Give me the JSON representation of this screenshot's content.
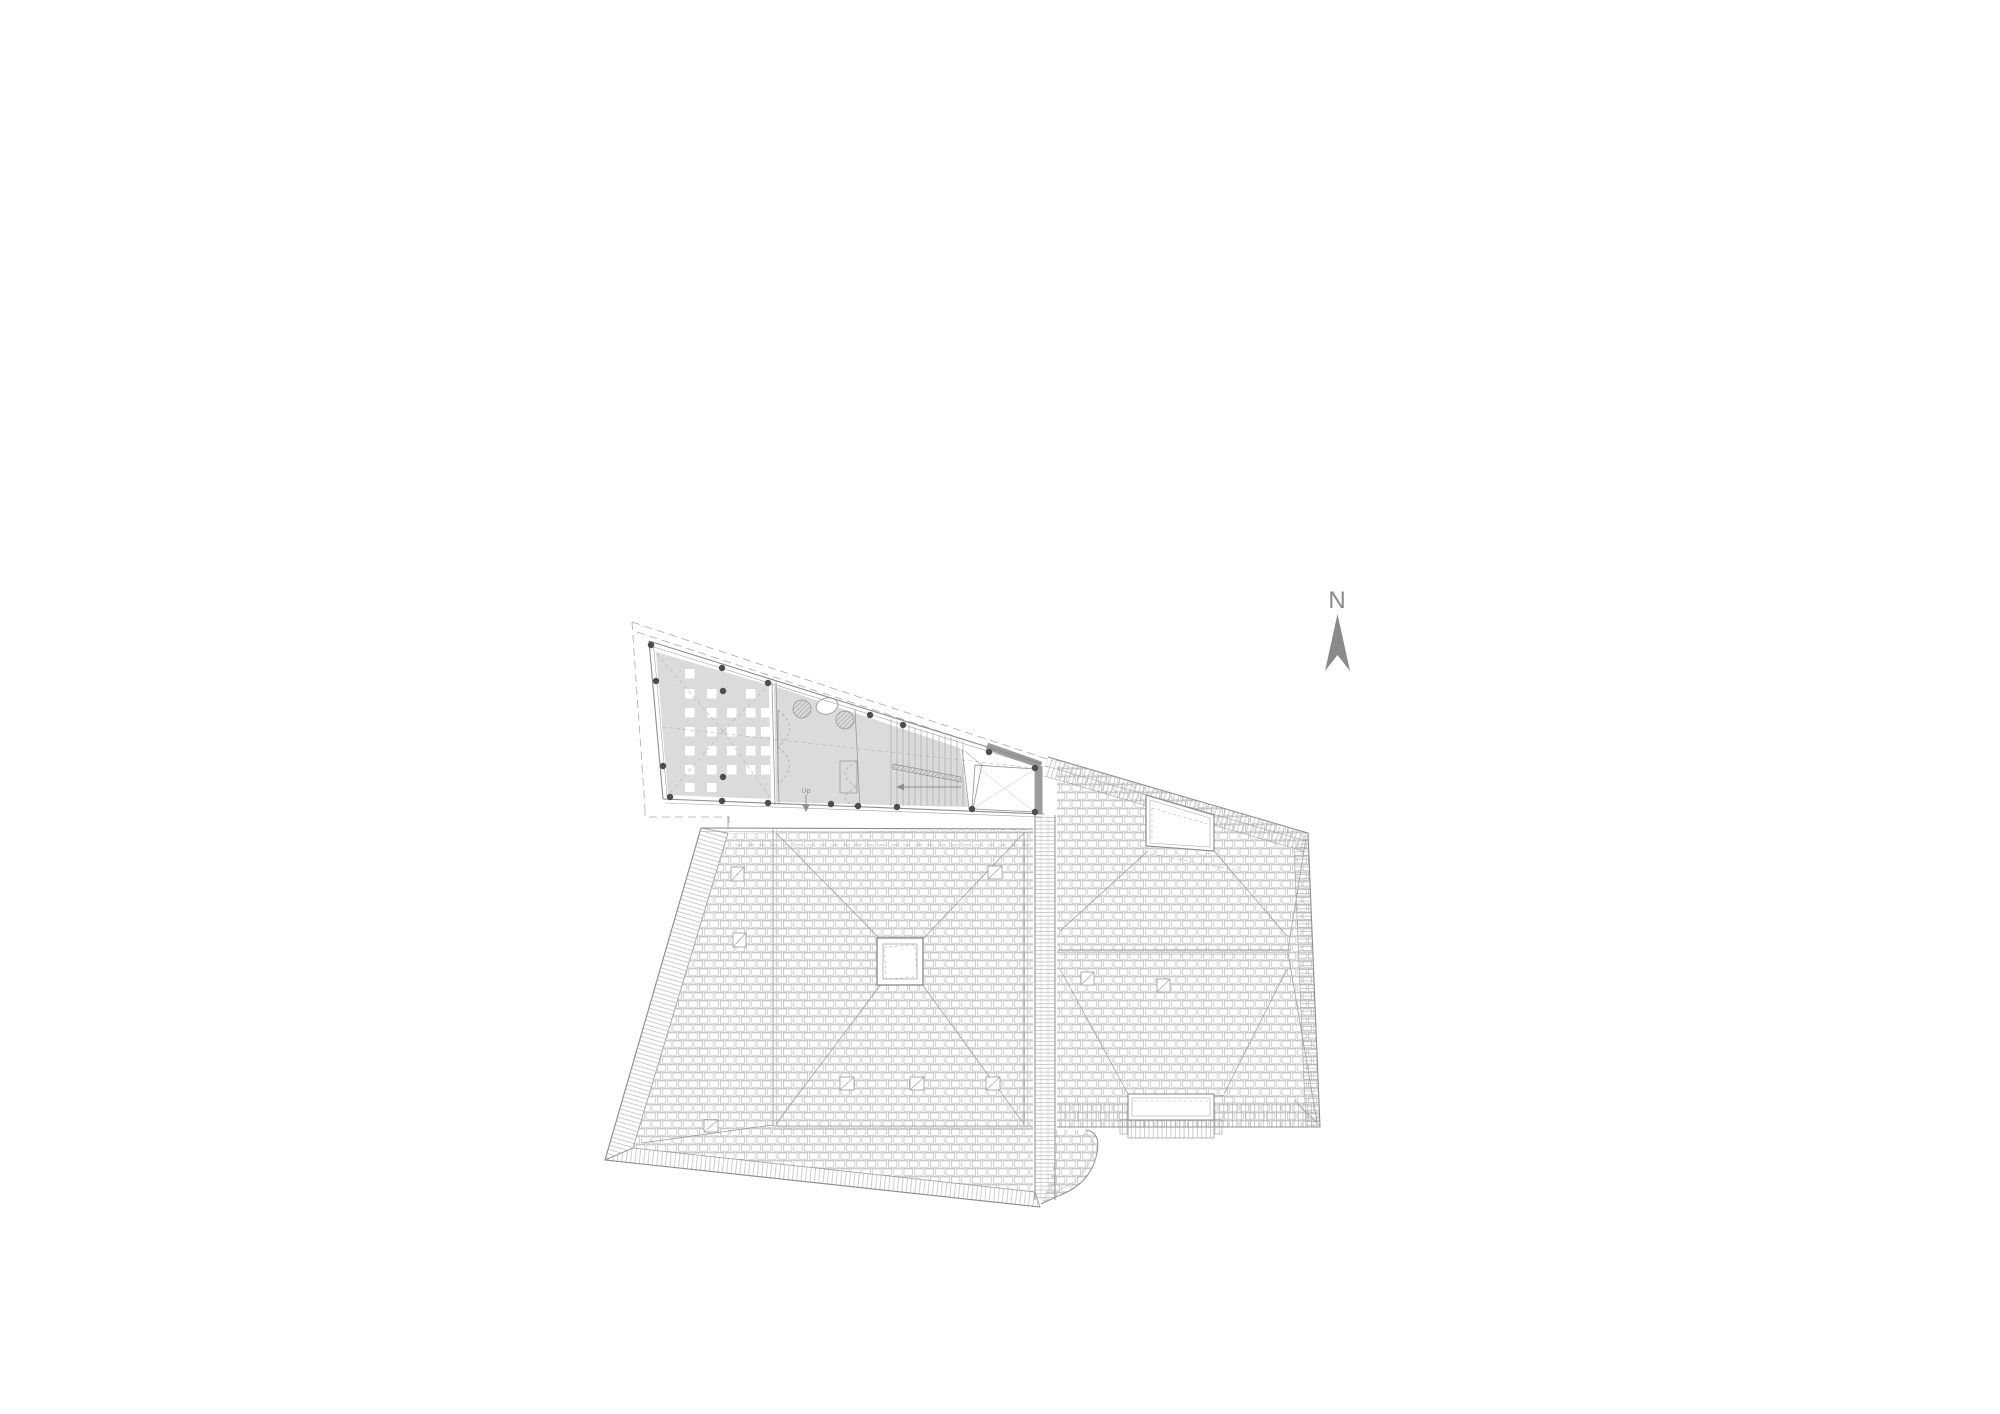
{
  "page": {
    "background_color": "#ffffff",
    "width_px": 2000,
    "height_px": 1414
  },
  "drawing": {
    "kind": "architectural roof plan / attic level plan",
    "labels": {
      "north": "N",
      "stair_up": "Up"
    },
    "colors": {
      "paper": "#ffffff",
      "line": "#979797",
      "line_light": "#adadad",
      "dashed_line": "#b0b0b0",
      "floor_fill": "#dbdbdb",
      "thick_wall": "#9b9b9b",
      "column_dot": "#4d4d4d",
      "north_arrow": "#8a8a8a"
    },
    "elements": {
      "wedge_building": "triangular attic floor with grid of roof lights, planting, door swings and staircase",
      "left_roof": "large hipped tiled roof with central square skylight, eave bands and seven roof hatches",
      "right_roof": "hipped tiled roof with ridge, two dormers and two roof hatches",
      "junction_gutter": "vertical gutter strip between the two roofs",
      "north_arrow": "compass needle pointing up"
    }
  }
}
